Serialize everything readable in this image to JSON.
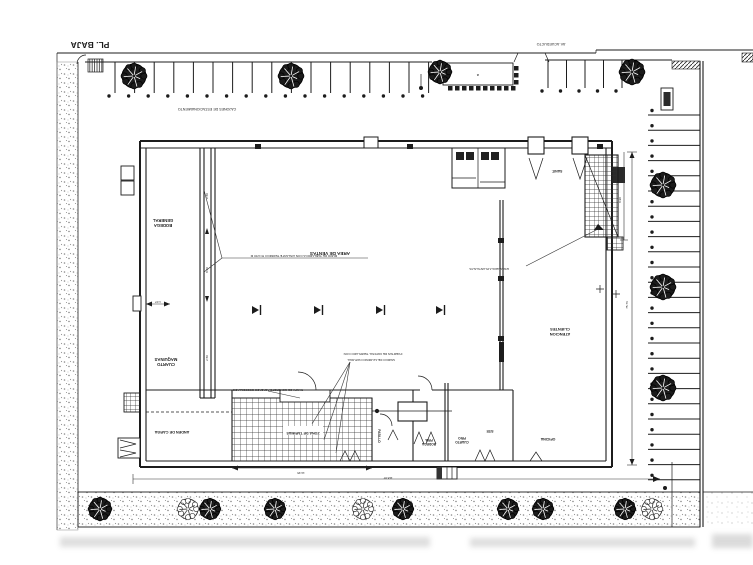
{
  "title": "PL. BAJA",
  "street_label": "AV. ACUEDUCTO",
  "colors": {
    "ink": "#1c1c1c",
    "mid": "#444444",
    "stipple": "#8a8a8a",
    "paper": "#ffffff"
  },
  "labels": [
    {
      "id": "parking-top-label",
      "text": "CAJONES DE ESTACIONAMIENTO",
      "x": 207,
      "y": 108,
      "fs": 3.6,
      "rot": 180,
      "bold": false
    },
    {
      "id": "canopy-letter",
      "text": "a",
      "x": 478,
      "y": 74,
      "fs": 4,
      "rot": 180,
      "bold": false
    },
    {
      "id": "room-bodega",
      "text": "BODEGA\nGENERAL",
      "x": 163,
      "y": 224,
      "fs": 4.2,
      "rot": 180,
      "bold": true
    },
    {
      "id": "room-maquinas",
      "text": "CUARTO\nMAQUINAS",
      "x": 166,
      "y": 363,
      "fs": 4.2,
      "rot": 180,
      "bold": true
    },
    {
      "id": "room-anden",
      "text": "ANDEN DE CARGA",
      "x": 172,
      "y": 431,
      "fs": 3.8,
      "rot": 180,
      "bold": true
    },
    {
      "id": "room-ventas",
      "text": "AREA DE VENTAS",
      "x": 330,
      "y": 252,
      "fs": 4.6,
      "rot": 180,
      "bold": true
    },
    {
      "id": "room-atencion",
      "text": "ATENCION\nCLIENTES",
      "x": 560,
      "y": 333,
      "fs": 4,
      "rot": 180,
      "bold": true
    },
    {
      "id": "room-sanitarios",
      "text": "SANIT.",
      "x": 557,
      "y": 170,
      "fs": 3.4,
      "rot": 180,
      "bold": true
    },
    {
      "id": "room-tarimas",
      "text": "ZONA DE TARIMAS",
      "x": 303,
      "y": 432,
      "fs": 3.6,
      "rot": 180,
      "bold": true,
      "bg": true
    },
    {
      "id": "room-pasillo",
      "text": "PASILLO",
      "x": 378,
      "y": 436,
      "fs": 3.2,
      "rot": 90,
      "bold": true
    },
    {
      "id": "room-bodega-fria",
      "text": "BODEGA\nFRIA",
      "x": 429,
      "y": 443,
      "fs": 3.2,
      "rot": 180,
      "bold": true
    },
    {
      "id": "room-cuarto-frio",
      "text": "CUARTO\nFRIO",
      "x": 462,
      "y": 441,
      "fs": 3.2,
      "rot": 180,
      "bold": true
    },
    {
      "id": "room-site",
      "text": "SITE",
      "x": 490,
      "y": 430,
      "fs": 3.2,
      "rot": 180,
      "bold": true
    },
    {
      "id": "room-oficina",
      "text": "OFICINA",
      "x": 548,
      "y": 438,
      "fs": 3.6,
      "rot": 180,
      "bold": true
    }
  ],
  "annotations": [
    {
      "id": "muro-note",
      "text": "MURO DE TABLAROCA CON AISLANTE TERMICO H=4.50 M",
      "x": 294,
      "y": 255,
      "fs": 3.1,
      "rot": 180
    },
    {
      "id": "escalera-note",
      "text": "ESCALERA A PLANTA ALTA",
      "x": 489,
      "y": 268,
      "fs": 3.1,
      "rot": 180
    },
    {
      "id": "puertas-note",
      "text": "PUERTAS DE CRISTAL TEMPLADO CON",
      "x": 373,
      "y": 353,
      "fs": 3.1,
      "rot": 180
    },
    {
      "id": "puertas-note-2",
      "text": "MARCO DE ALUMINIO NATURAL",
      "x": 371,
      "y": 359,
      "fs": 3.1,
      "rot": 180
    },
    {
      "id": "anden-note",
      "text": "RAMPA DE CONCRETO ACABADO ESCOBILLADO",
      "x": 268,
      "y": 389,
      "fs": 3.0,
      "rot": 180
    }
  ],
  "dimensions": [
    {
      "id": "dim-notch",
      "text": "1.07",
      "x": 158,
      "y": 301,
      "fs": 3,
      "rot": 180
    },
    {
      "id": "dim-hatch",
      "text": "14.35",
      "x": 301,
      "y": 472,
      "fs": 3,
      "rot": 180
    },
    {
      "id": "dim-total-width",
      "text": "118.87",
      "x": 388,
      "y": 477,
      "fs": 3,
      "rot": 180
    },
    {
      "id": "dim-total-height",
      "text": "75.76",
      "x": 628,
      "y": 305,
      "fs": 3,
      "rot": 270
    },
    {
      "id": "dim-stair",
      "text": "8.90",
      "x": 621,
      "y": 200,
      "fs": 3,
      "rot": 270
    },
    {
      "id": "dim-rack-1",
      "text": "2.50",
      "x": 208,
      "y": 196,
      "fs": 3,
      "rot": 270
    },
    {
      "id": "dim-rack-2",
      "text": "8.40",
      "x": 208,
      "y": 270,
      "fs": 3,
      "rot": 270
    },
    {
      "id": "dim-rack-3",
      "text": "2.50",
      "x": 208,
      "y": 358,
      "fs": 3,
      "rot": 270
    }
  ],
  "parking": {
    "top_a": {
      "x0": 115,
      "x1": 429,
      "step": 19.6,
      "y0": 62,
      "y1": 93,
      "dot_y": 96
    },
    "top_b": {
      "x0": 548,
      "x1": 623,
      "step": 18.5,
      "y0": 60,
      "y1": 88,
      "dot_y": 91
    },
    "right": {
      "y0": 115,
      "y1": 481,
      "step": 15.2,
      "x0": 648,
      "x1": 700,
      "dot_x": 652
    }
  },
  "trees": {
    "top": [
      [
        134,
        76,
        12,
        "dark"
      ],
      [
        291,
        76,
        12,
        "dark"
      ],
      [
        440,
        72,
        11,
        "dark"
      ],
      [
        632,
        72,
        12,
        "dark"
      ]
    ],
    "right": [
      [
        663,
        185,
        12,
        "dark"
      ],
      [
        663,
        287,
        12,
        "dark"
      ],
      [
        663,
        388,
        12,
        "dark"
      ]
    ],
    "bottom": [
      [
        100,
        509,
        11,
        "dark"
      ],
      [
        188,
        509,
        10,
        "light"
      ],
      [
        210,
        509,
        10,
        "dark"
      ],
      [
        275,
        509,
        10,
        "dark"
      ],
      [
        363,
        509,
        10,
        "light"
      ],
      [
        403,
        509,
        10,
        "dark"
      ],
      [
        508,
        509,
        10,
        "dark"
      ],
      [
        543,
        509,
        10,
        "dark"
      ],
      [
        625,
        509,
        10,
        "dark"
      ],
      [
        652,
        509,
        10,
        "light"
      ]
    ]
  },
  "entrance": {
    "squares_bottom": {
      "x0": 448,
      "x1": 511,
      "step": 7,
      "y": 86,
      "size": 4.5
    },
    "squares_right": {
      "x": 514,
      "ys": [
        66,
        73,
        80
      ],
      "size": 4.5
    }
  },
  "door_markers": {
    "y": 310,
    "xs": [
      258,
      320,
      382,
      442
    ]
  }
}
